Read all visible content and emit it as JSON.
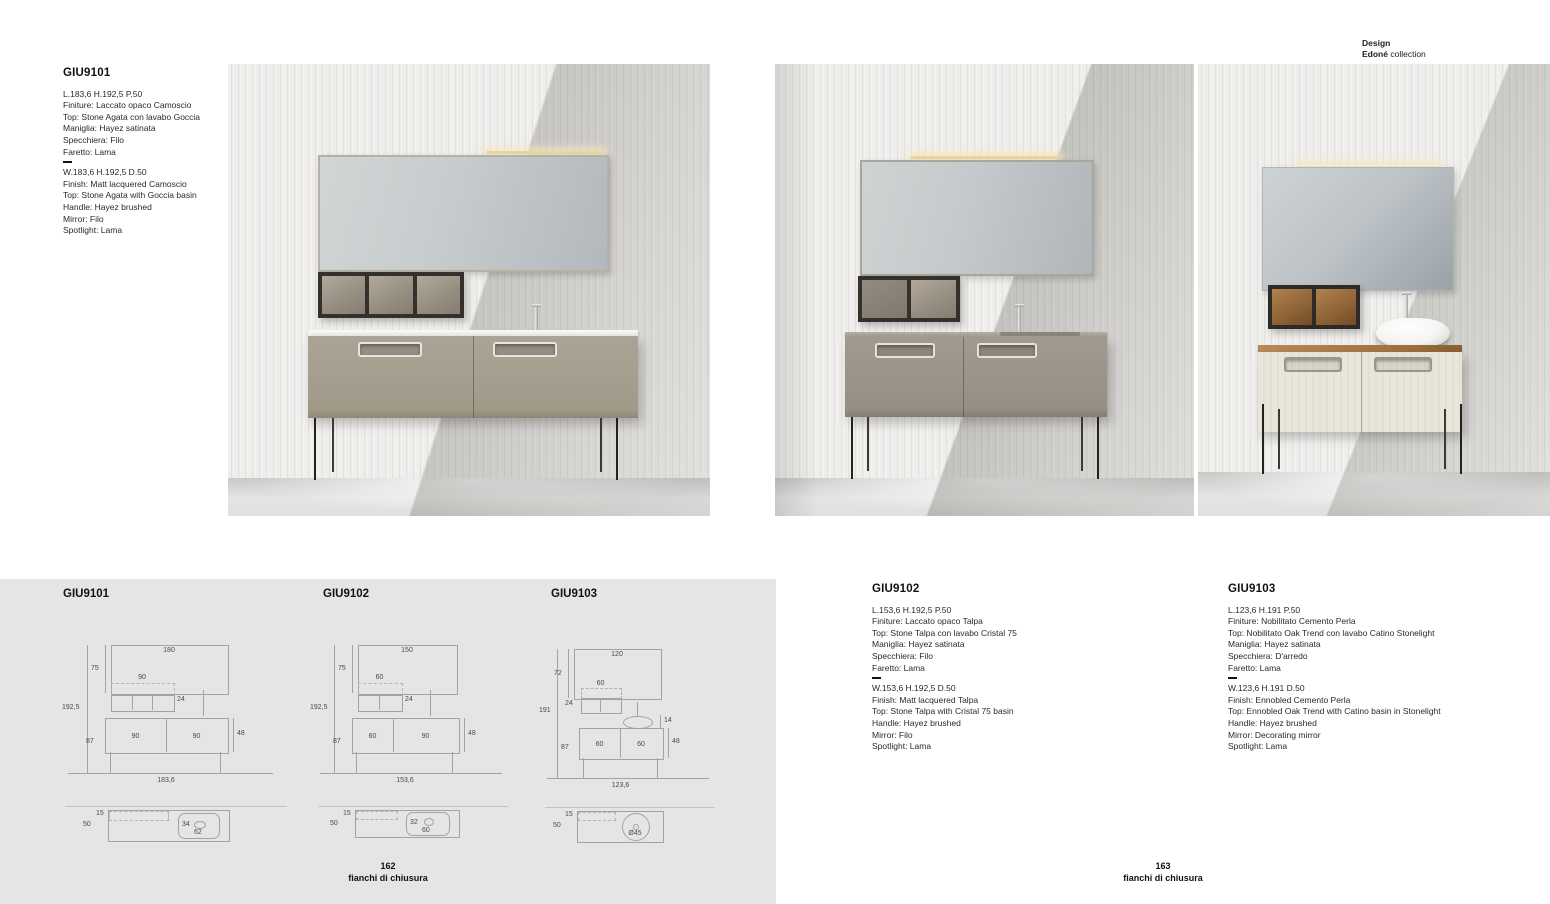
{
  "credit": {
    "design": "Design",
    "brand": "Edoné",
    "suffix": " collection"
  },
  "footer_left": {
    "num": "162",
    "label": "fianchi di chiusura"
  },
  "footer_right": {
    "num": "163",
    "label": "fianchi di chiusura"
  },
  "specs": {
    "s1": {
      "code": "GIU9101",
      "it": [
        "L.183,6 H.192,5 P.50",
        "Finiture: Laccato opaco Camoscio",
        "Top: Stone Agata con lavabo Goccia",
        "Maniglia: Hayez satinata",
        "Specchiera: Filo",
        "Faretto: Lama"
      ],
      "en": [
        "W.183,6 H.192,5 D.50",
        "Finish: Matt lacquered Camoscio",
        "Top: Stone Agata with Goccia basin",
        "Handle: Hayez brushed",
        "Mirror: Filo",
        "Spotlight: Lama"
      ]
    },
    "s2": {
      "code": "GIU9102",
      "it": [
        "L.153,6 H.192,5 P.50",
        "Finiture: Laccato opaco Talpa",
        "Top: Stone Talpa con lavabo Cristal 75",
        "Maniglia: Hayez satinata",
        "Specchiera: Filo",
        "Faretto: Lama"
      ],
      "en": [
        "W.153,6 H.192,5 D.50",
        "Finish: Matt lacquered Talpa",
        "Top: Stone Talpa with Cristal 75 basin",
        "Handle: Hayez brushed",
        "Mirror: Filo",
        "Spotlight: Lama"
      ]
    },
    "s3": {
      "code": "GIU9103",
      "it": [
        "L.123,6 H.191 P.50",
        "Finiture: Nobilitato Cemento Perla",
        "Top: Nobilitato Oak Trend con lavabo Catino Stonelight",
        "Maniglia: Hayez satinata",
        "Specchiera: D'arredo",
        "Faretto: Lama"
      ],
      "en": [
        "W.123,6 H.191 D.50",
        "Finish: Ennobled Cemento Perla",
        "Top: Ennobled Oak Trend with Catino basin in Stonelight",
        "Handle: Hayez brushed",
        "Mirror: Decorating mirror",
        "Spotlight: Lama"
      ]
    }
  },
  "drawings": {
    "d1": {
      "title": "GIU9101",
      "mirror_w": "180",
      "mirror_h": "75",
      "shelf_w": "90",
      "shelf_d": "24",
      "total_h": "192,5",
      "base_h": "87",
      "door_a": "90",
      "door_b": "90",
      "cab_h": "48",
      "total_w": "183,6",
      "plan_top": "15",
      "plan_depth": "50",
      "basin_a": "34",
      "basin_b": "62"
    },
    "d2": {
      "title": "GIU9102",
      "mirror_w": "150",
      "mirror_h": "75",
      "shelf_w": "60",
      "shelf_d": "24",
      "total_h": "192,5",
      "base_h": "87",
      "door_a": "60",
      "door_b": "90",
      "cab_h": "48",
      "total_w": "153,6",
      "plan_top": "15",
      "plan_depth": "50",
      "basin_a": "32",
      "basin_b": "60"
    },
    "d3": {
      "title": "GIU9103",
      "mirror_w": "120",
      "mirror_h": "72",
      "shelf_w": "60",
      "shelf_d": "24",
      "total_h": "191",
      "base_h": "87",
      "door_a": "60",
      "door_b": "60",
      "cab_h": "48",
      "basin_h": "14",
      "total_w": "123,6",
      "plan_top": "15",
      "plan_depth": "50",
      "basin_diam": "Ø45"
    }
  },
  "colors": {
    "panel_bg": "#e4e6e4",
    "camoscio": "#a79f92",
    "talpa": "#9b968c",
    "cemento_perla": "#e7e5da",
    "oak_trend": "#a0713d",
    "leg_black": "#23221f",
    "spotlight_glow": "#f6e8b9"
  }
}
